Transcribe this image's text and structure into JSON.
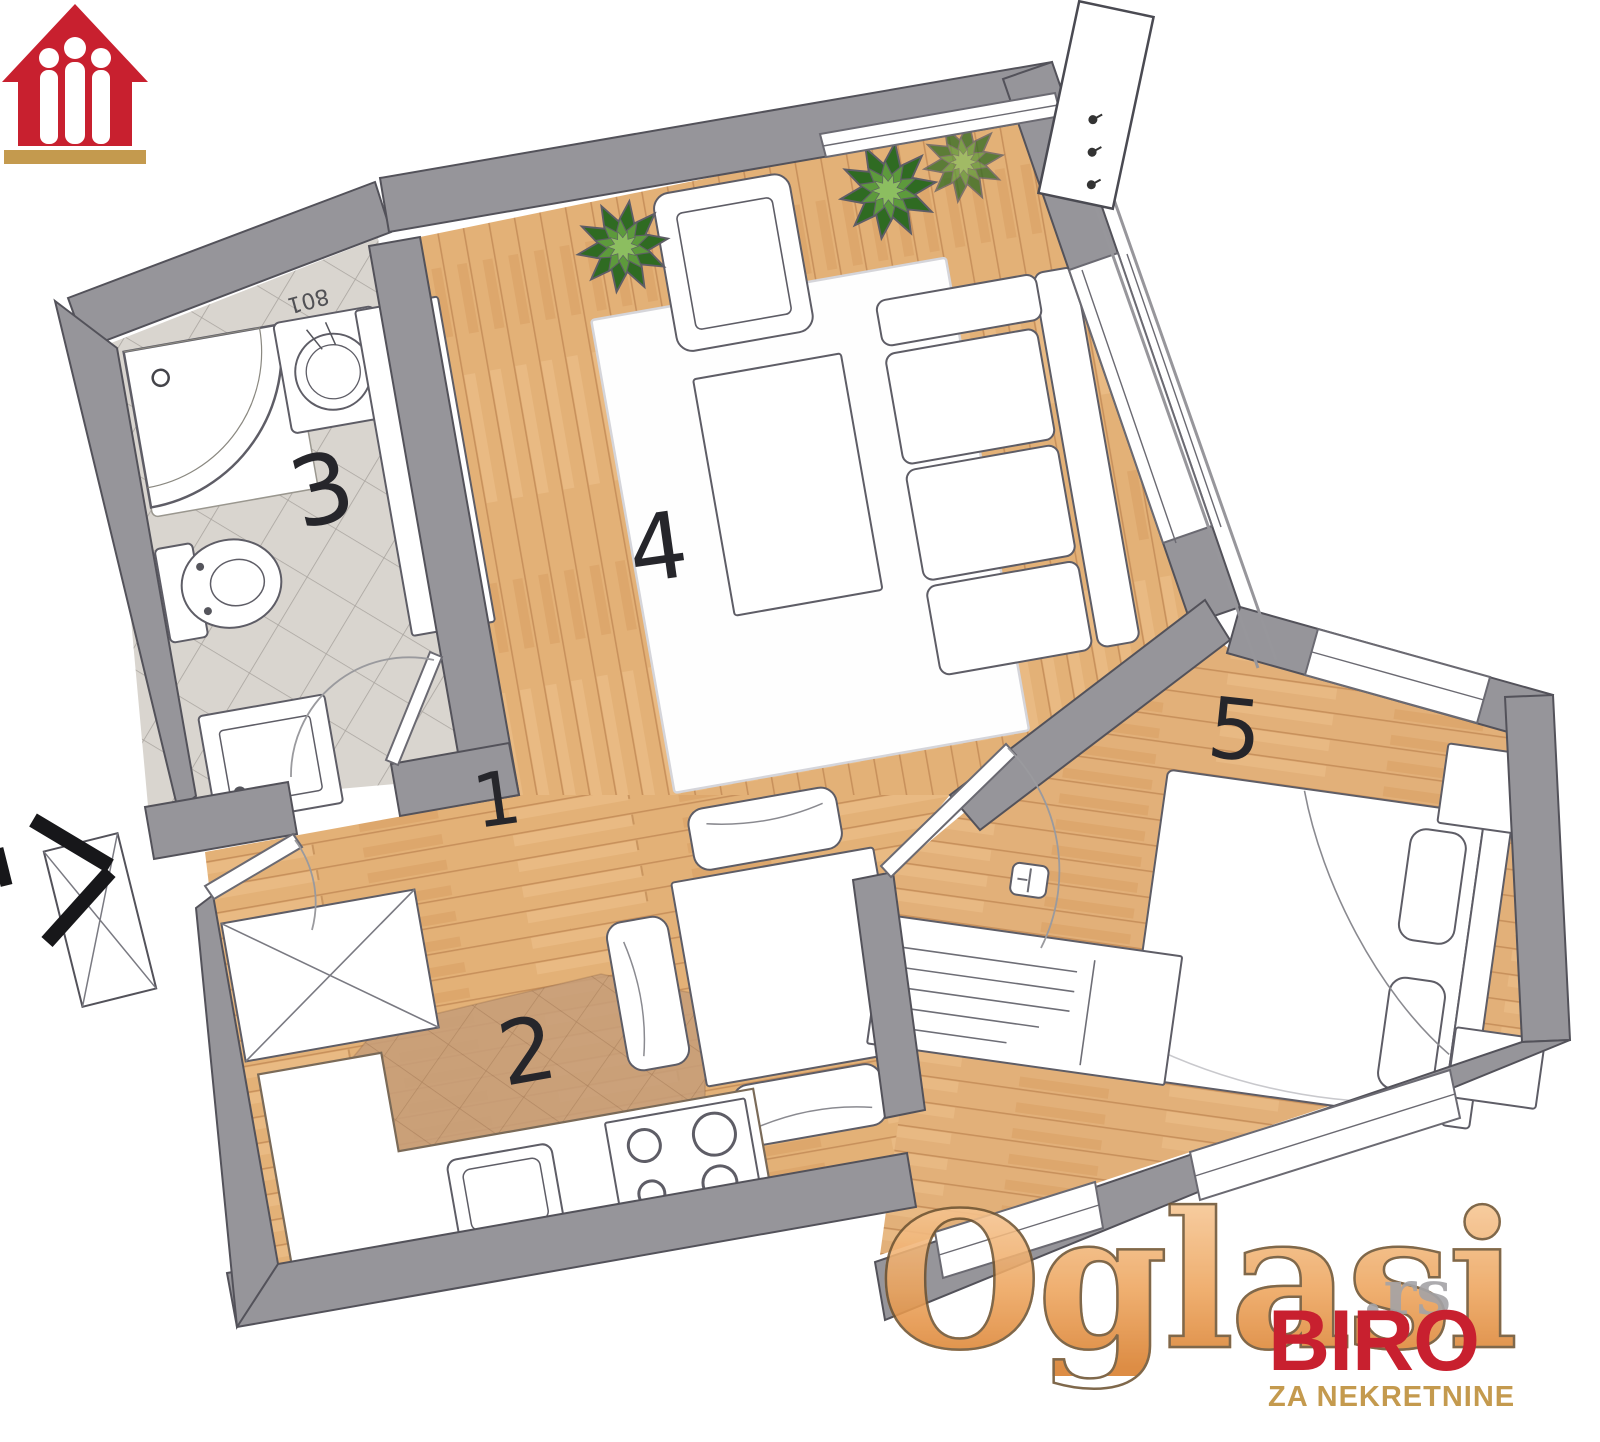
{
  "title": "apartment-floor-plan",
  "rooms": [
    {
      "id": "hallway",
      "number": "1"
    },
    {
      "id": "kitchen",
      "number": "2"
    },
    {
      "id": "bathroom",
      "number": "3"
    },
    {
      "id": "living-room",
      "number": "4"
    },
    {
      "id": "bedroom",
      "number": "5"
    }
  ],
  "annotations": {
    "washer_label": "801"
  },
  "watermark": {
    "brand": "Oglasi",
    "tld": ".rs",
    "agency_name": "BIRO",
    "agency_subtitle": "ZA NEKRETNINE"
  },
  "colors": {
    "wall": "#96959A",
    "wall_stroke": "#53525A",
    "wood": "#E3B177",
    "wood_line": "#C28A55",
    "tile_bathroom": "#D9D5CF",
    "tile_kitchen": "#C79E79",
    "furniture_fill": "#FFFFFF",
    "furniture_stroke": "#5E5D66",
    "plant_dark": "#2F6B22",
    "plant_light": "#7FB356",
    "label": "#26262B",
    "watermark_orange": "#ED9E53",
    "logo_red": "#C8202F",
    "logo_gold": "#C49A4E"
  }
}
